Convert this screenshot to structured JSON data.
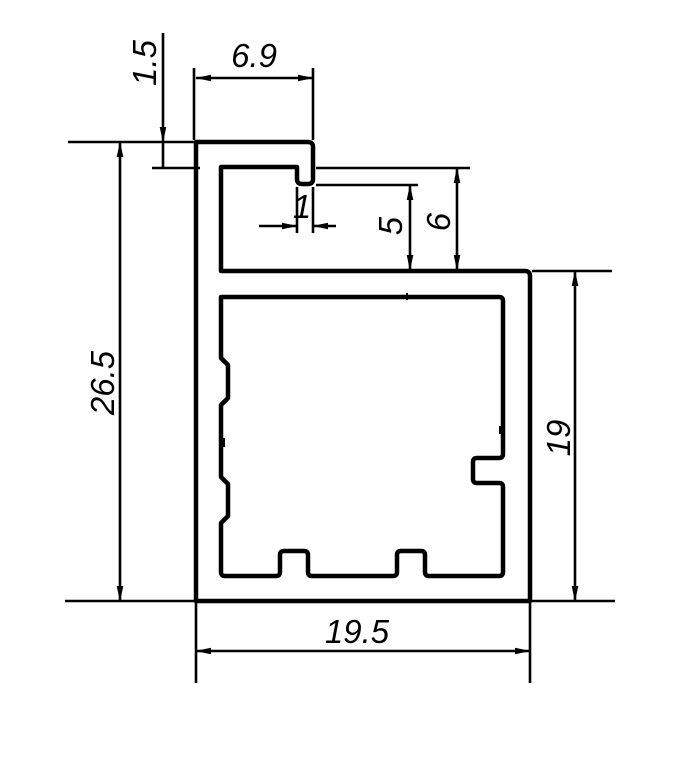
{
  "drawing": {
    "colors": {
      "profile_fill": "#818181",
      "line_color": "#000000",
      "background": "#ffffff"
    },
    "dimensions": {
      "flange_thickness": "1.5",
      "flange_width": "6.9",
      "lip_width": "1",
      "lip_to_body_gap": "5",
      "flange_to_body_gap": "6",
      "overall_height": "26.5",
      "body_height": "19",
      "overall_width": "19.5"
    }
  }
}
